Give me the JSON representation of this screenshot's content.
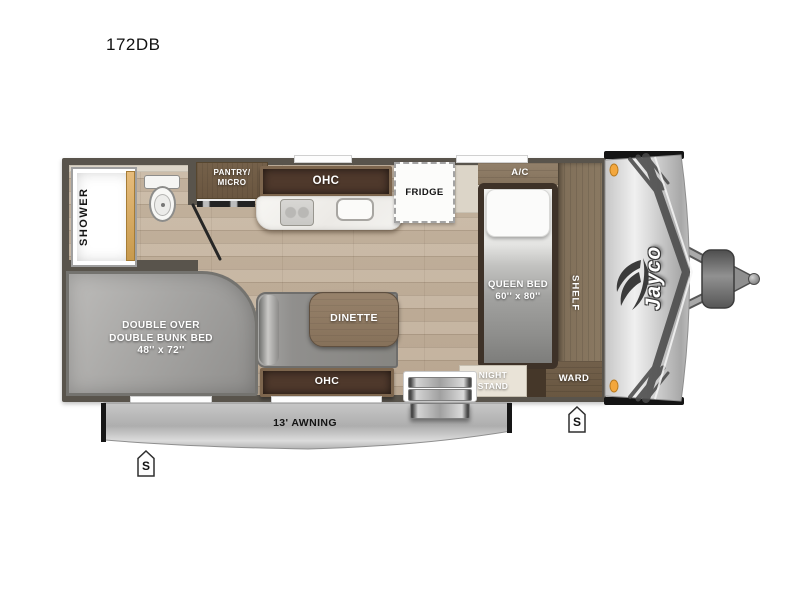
{
  "title": "172DB",
  "brand": "Jayco",
  "palette": {
    "floor_wood": "#c5b4a0",
    "wall": "#59544c",
    "cabinet_dark": "#4f392c",
    "cabinet_trim": "#7d664e",
    "deck_wood": "#8a7862",
    "ward_wood": "#6e5c47",
    "furniture_gray": "#908f8d",
    "awning_gray": "#bdbdbd",
    "marker_amber": "#f3a73d",
    "counter_white": "#f3f2ef"
  },
  "labels": {
    "shower": "SHOWER",
    "pantry_line1": "PANTRY/",
    "pantry_line2": "MICRO",
    "kitchen_ohc": "OHC",
    "fridge": "FRIDGE",
    "ac": "A/C",
    "queen_line1": "QUEEN BED",
    "queen_line2": "60'' x 80''",
    "shelf": "SHELF",
    "night_line1": "NIGHT",
    "night_line2": "STAND",
    "ward": "WARD",
    "dinette": "DINETTE",
    "dinette_ohc": "OHC",
    "bunk_line1": "DOUBLE OVER",
    "bunk_line2": "DOUBLE BUNK BED",
    "bunk_line3": "48'' x 72''",
    "awning": "13' AWNING",
    "speaker": "S"
  }
}
